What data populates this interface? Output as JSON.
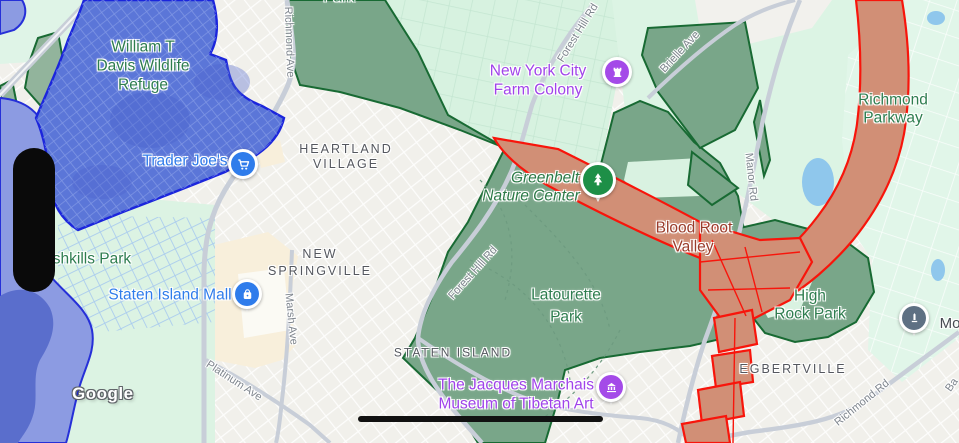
{
  "attribution": "Google",
  "colors": {
    "park_fill": "#79A689",
    "park_outline": "#186A33",
    "selection_blue_fill": "#5B76D8",
    "selection_blue_outline": "#1B25DC",
    "corridor_fill": "#D18F76",
    "corridor_outline": "#F8150B",
    "poi_blue": "#2F7CEB",
    "poi_purple": "#A44AE8",
    "poi_green": "#1D8F47",
    "poi_gray": "#5E7083"
  },
  "labels": {
    "park_top": "Park",
    "refuge": {
      "l1": "William T",
      "l2": "Davis Wildlife",
      "l3": "Refuge"
    },
    "trader_joes": "Trader Joe's",
    "heartland": {
      "l1": "HEARTLAND",
      "l2": "VILLAGE"
    },
    "farm_colony": {
      "l1": "New York City",
      "l2": "Farm Colony"
    },
    "greenbelt": {
      "l1": "Greenbelt",
      "l2": "Nature Center"
    },
    "richmond_pkwy": {
      "l1": "Richmond",
      "l2": "Parkway"
    },
    "blood_root": {
      "l1": "Blood Root",
      "l2": "Valley"
    },
    "freshkills": "shkills Park",
    "new_springville": {
      "l1": "NEW",
      "l2": "SPRINGVILLE"
    },
    "si_mall": "Staten Island Mall",
    "latourette": {
      "l1": "Latourette",
      "l2": "Park"
    },
    "high_rock": {
      "l1": "High",
      "l2": "Rock Park"
    },
    "staten_island": "STATEN ISLAND",
    "museum": {
      "l1": "The Jacques Marchais",
      "l2": "Museum of Tibetan Art"
    },
    "egbertville": "EGBERTVILLE",
    "moravian_partial": "Mo"
  },
  "roads": {
    "richmond_ave": "Richmond Ave",
    "forest_hill_top": "Forest Hill Rd",
    "brielle": "Brielle Ave",
    "manor": "Manor Rd",
    "forest_hill_mid": "Forest Hill Rd",
    "marsh": "Marsh Ave",
    "platinum": "Platinum Ave",
    "richmond_rd": "Richmond Rd",
    "ba_partial": "Ba"
  }
}
